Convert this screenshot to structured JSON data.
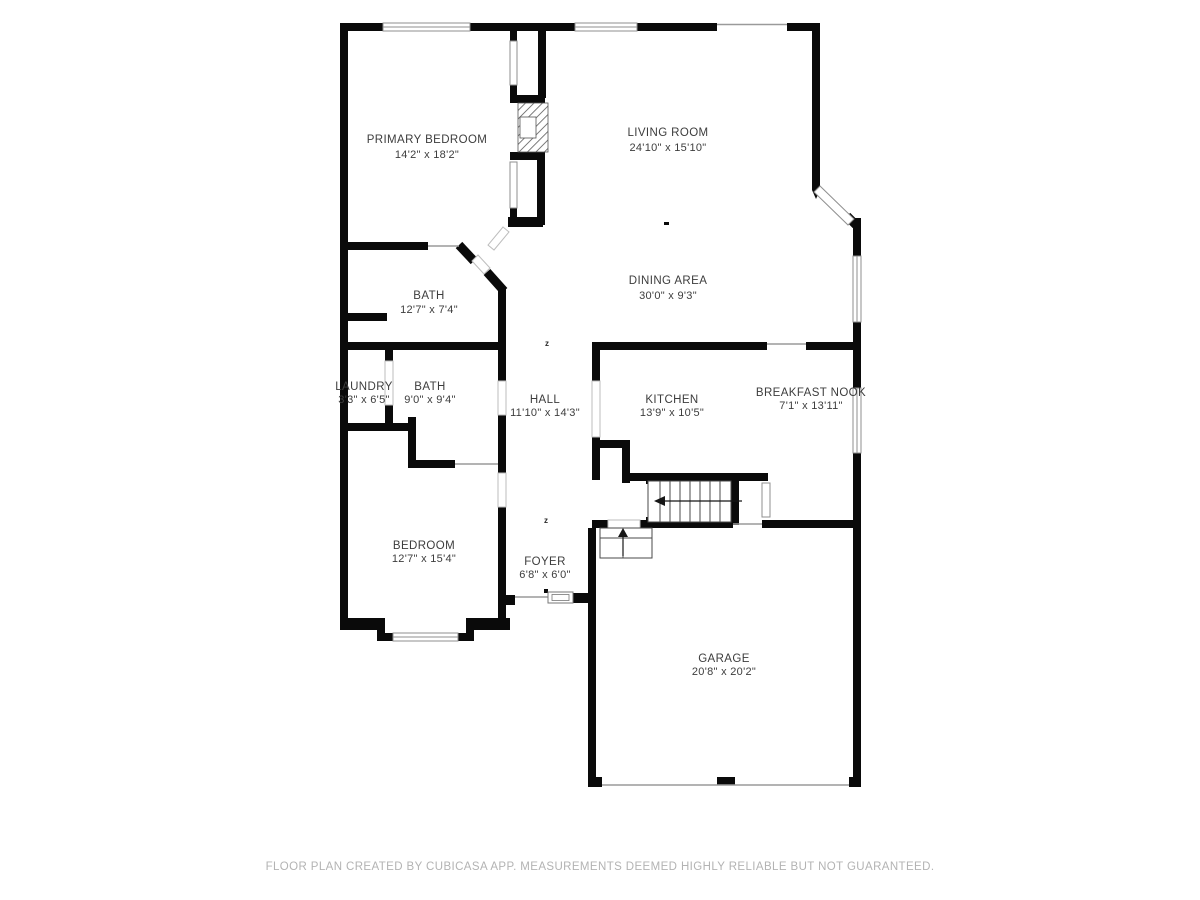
{
  "rooms": [
    {
      "id": "primary-bedroom",
      "name": "PRIMARY BEDROOM",
      "dims": "14'2\" x 18'2\""
    },
    {
      "id": "living-room",
      "name": "LIVING ROOM",
      "dims": "24'10\" x 15'10\""
    },
    {
      "id": "dining-area",
      "name": "DINING AREA",
      "dims": "30'0\" x 9'3\""
    },
    {
      "id": "bath-1",
      "name": "BATH",
      "dims": "12'7\" x 7'4\""
    },
    {
      "id": "laundry",
      "name": "LAUNDRY",
      "dims": "3'3\" x 6'5\""
    },
    {
      "id": "bath-2",
      "name": "BATH",
      "dims": "9'0\" x 9'4\""
    },
    {
      "id": "hall",
      "name": "HALL",
      "dims": "11'10\" x 14'3\""
    },
    {
      "id": "kitchen",
      "name": "KITCHEN",
      "dims": "13'9\" x 10'5\""
    },
    {
      "id": "breakfast-nook",
      "name": "BREAKFAST NOOK",
      "dims": "7'1\" x 13'11\""
    },
    {
      "id": "bedroom",
      "name": "BEDROOM",
      "dims": "12'7\" x 15'4\""
    },
    {
      "id": "foyer",
      "name": "FOYER",
      "dims": "6'8\" x 6'0\""
    },
    {
      "id": "garage",
      "name": "GARAGE",
      "dims": "20'8\" x 20'2\""
    }
  ],
  "symbols": {
    "ceiling_marker": "z"
  },
  "footer": "FLOOR PLAN CREATED BY CUBICASA APP. MEASUREMENTS DEEMED HIGHLY RELIABLE BUT NOT GUARANTEED.",
  "colors": {
    "wall": "#0a0a0a",
    "room_label": "#3d3d3d",
    "footer_text": "#b3b3b3",
    "window_stroke": "#8f8f8f",
    "background": "#ffffff"
  }
}
